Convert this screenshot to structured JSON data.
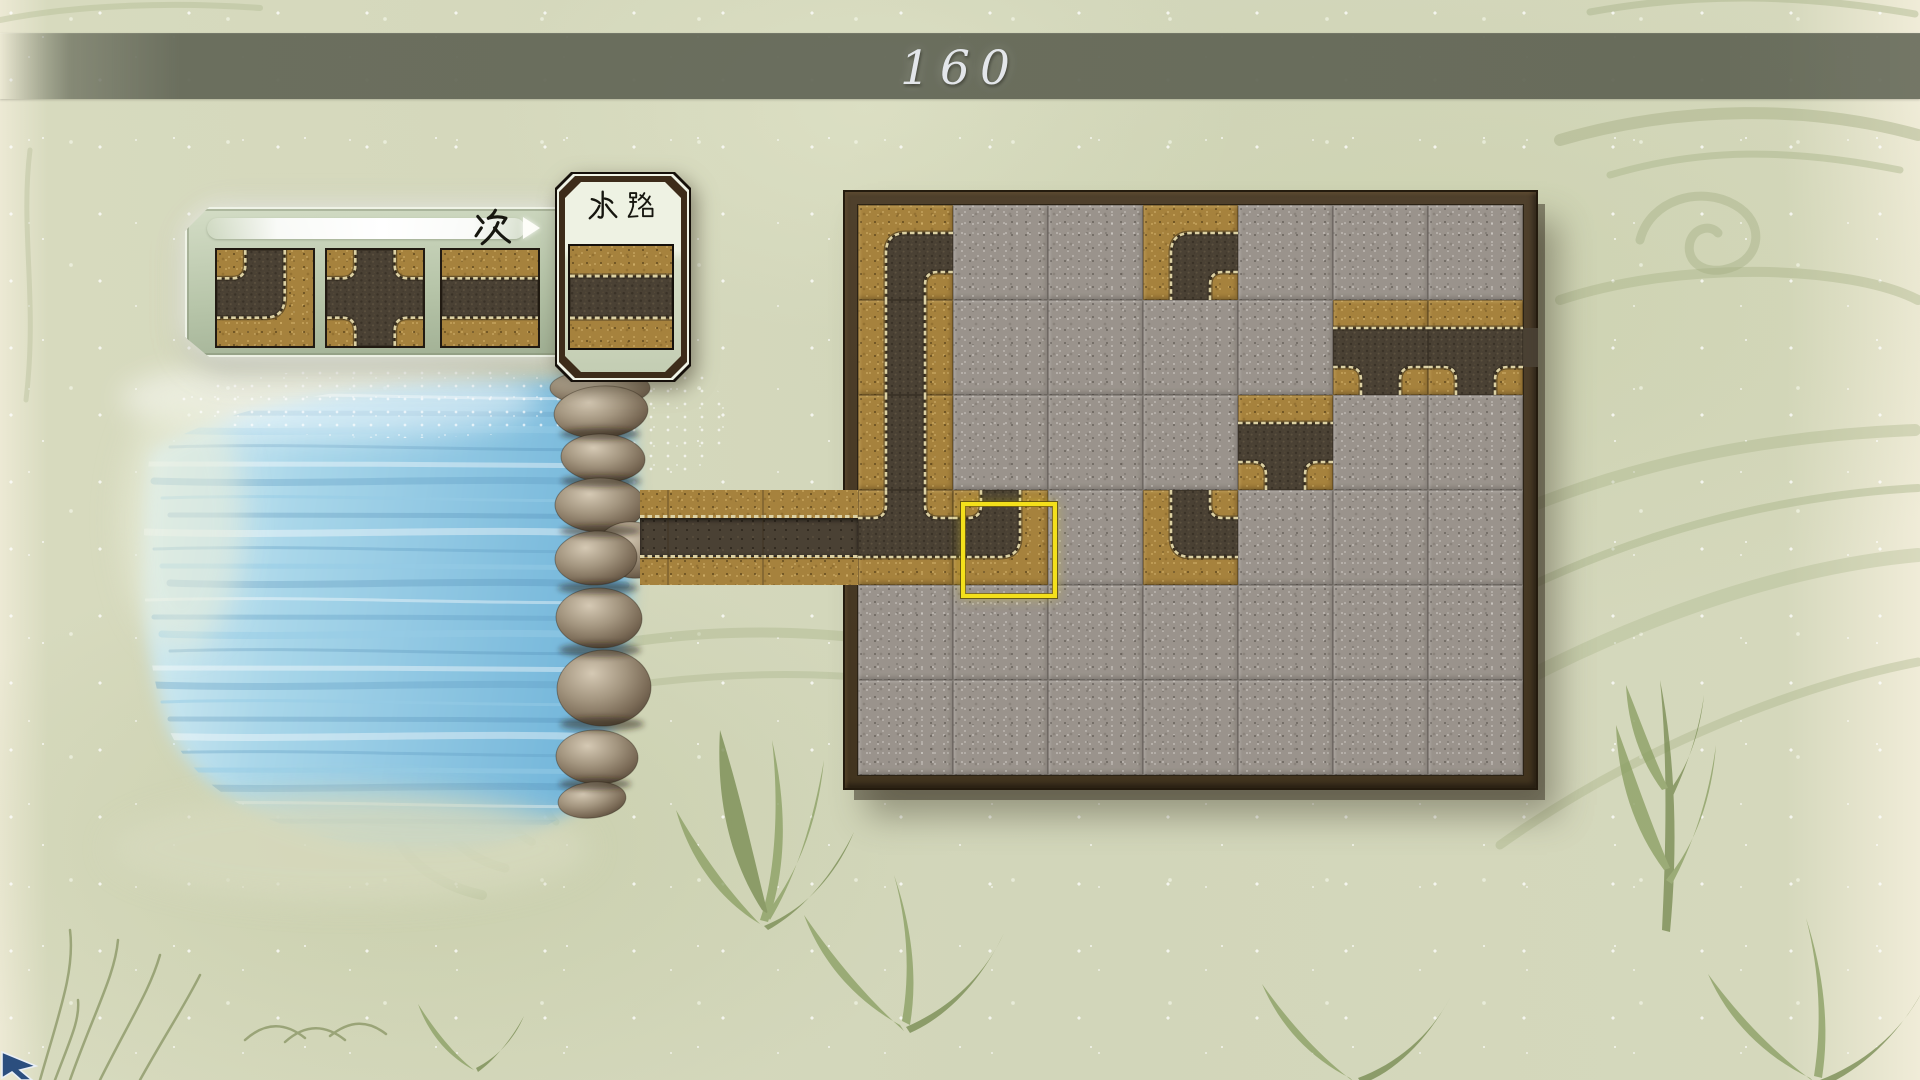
{
  "hud": {
    "counter": "160"
  },
  "next_panel": {
    "label": "次",
    "pieces": [
      {
        "name": "elbow-left-top",
        "connections": "LT"
      },
      {
        "name": "cross-junction",
        "connections": "LTRB"
      },
      {
        "name": "straight-horizontal",
        "connections": "LR"
      }
    ]
  },
  "stock_panel": {
    "label": "水路",
    "piece": {
      "name": "straight-horizontal",
      "connections": "LR"
    }
  },
  "board": {
    "cols": 7,
    "rows": 6,
    "cells": [
      [
        "RB",
        "",
        "",
        "RB",
        "",
        "",
        ""
      ],
      [
        "TB",
        "",
        "",
        "",
        "",
        "LRB",
        "LRB"
      ],
      [
        "TB",
        "",
        "",
        "",
        "LRB",
        "",
        ""
      ],
      [
        "LTR",
        "LT",
        "",
        "TR",
        "",
        "",
        ""
      ],
      [
        "",
        "",
        "",
        "",
        "",
        "",
        ""
      ],
      [
        "",
        "",
        "",
        "",
        "",
        "",
        ""
      ]
    ],
    "cursor": {
      "col": 1,
      "row": 3
    },
    "water_inlet": {
      "side": "left",
      "row": 3
    },
    "water_outlet": {
      "side": "right",
      "row": 1
    }
  },
  "colors": {
    "cursor_accent": "#f4e01b",
    "tile_sand": "#a6823d",
    "channel_dark": "#4a4134",
    "stone_grey": "#9a938c",
    "frame_brown": "#46382a",
    "water_blue": "#8ec6e2",
    "paper_green": "#d2d6ba",
    "bar_olive": "#64684f"
  }
}
